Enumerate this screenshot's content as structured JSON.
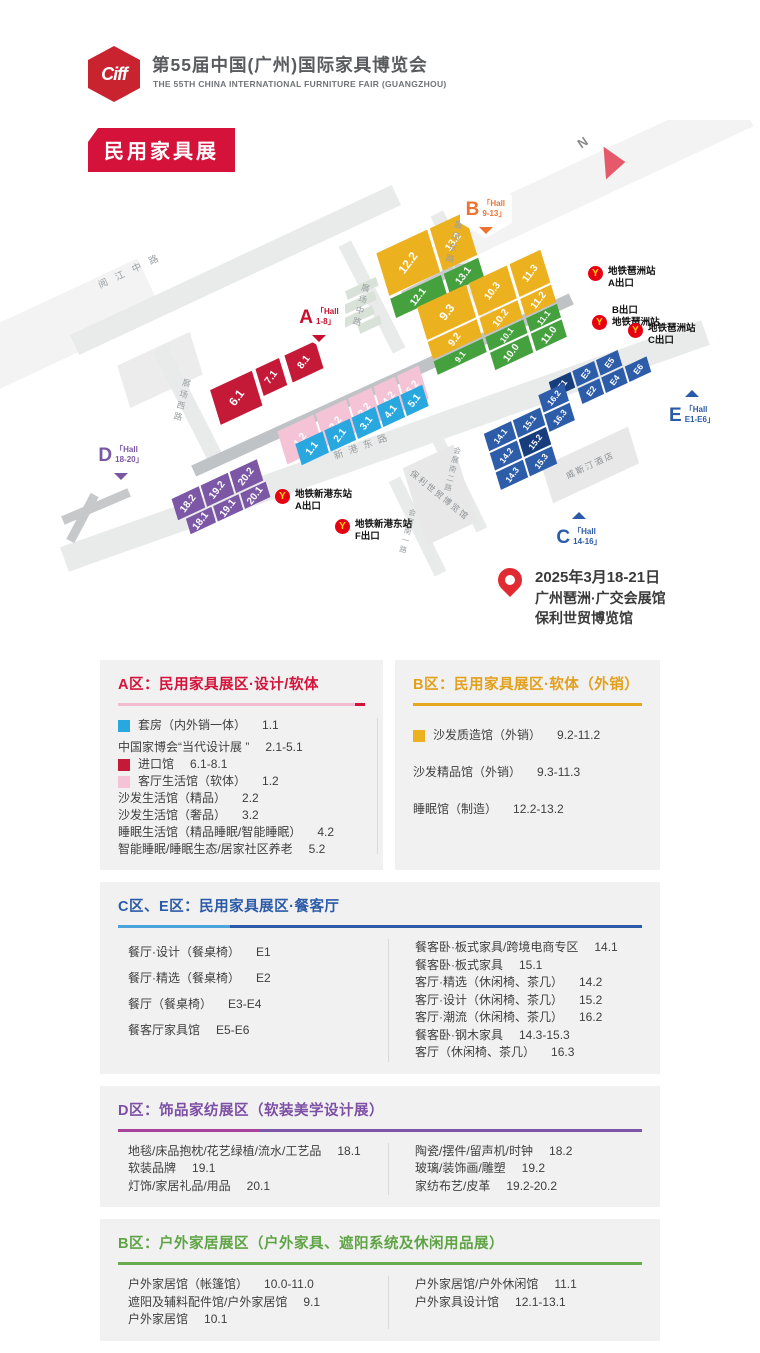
{
  "header": {
    "logo_text": "Ciff",
    "title": "第55届中国(广州)国际家具博览会",
    "subtitle": "THE 55TH CHINA INTERNATIONAL FURNITURE FAIR (GUANGZHOU)",
    "badge": "民用家具展"
  },
  "theme": {
    "zone_red": "#c41a38",
    "zone_pink": "#f4c3d6",
    "zone_cyan": "#29a8e0",
    "zone_yellow": "#ecb11f",
    "zone_green": "#44a13d",
    "zone_blue": "#2d5ca9",
    "zone_navy": "#173d7d",
    "zone_purple": "#7b57a5",
    "accent_a": "#d5133a",
    "accent_b": "#e5a71f",
    "accent_ce": "#2b5ba8",
    "accent_d": "#7d4fa5",
    "accent_b2": "#6aaa4e",
    "metro_red": "#e60012",
    "metro_yellow": "#ffd800"
  },
  "map": {
    "compass": "N",
    "hex": [
      {
        "letter": "A",
        "l1": "「Hall",
        "l2": "1-8」"
      },
      {
        "letter": "B",
        "l1": "「Hall",
        "l2": "9-13」"
      },
      {
        "letter": "C",
        "l1": "「Hall",
        "l2": "14-16」"
      },
      {
        "letter": "D",
        "l1": "「Hall",
        "l2": "18-20」"
      },
      {
        "letter": "E",
        "l1": "「Hall",
        "l2": "E1-E6」"
      }
    ],
    "blocks": {
      "red": [
        "6.1",
        "7.1",
        "8.1"
      ],
      "pink": [
        "1.2",
        "2.2",
        "3.2",
        "4.2",
        "5.2"
      ],
      "cyan": [
        "1.1",
        "2.1",
        "3.1",
        "4.1",
        "5.1"
      ],
      "y1213": [
        "12.2",
        "13.2"
      ],
      "g1213": [
        "12.1",
        "13.1"
      ],
      "y911": [
        "9.3",
        "10.3",
        "11.3",
        "9.2",
        "10.2",
        "11.2"
      ],
      "g911": [
        "9.1",
        "10.1",
        "11.1",
        "10.0",
        "11.0"
      ],
      "e": [
        "E1",
        "E3",
        "E5",
        "E2",
        "E4",
        "E6"
      ],
      "c": [
        "14.1",
        "15.1",
        "14.2",
        "15.2",
        "14.3",
        "15.3",
        "16.2",
        "16.3"
      ],
      "d": [
        "18.2",
        "19.2",
        "20.2",
        "18.1",
        "19.1",
        "20.1"
      ]
    },
    "streets": [
      "阅江中路",
      "展场西路",
      "展场中路",
      "展场东路",
      "新港东路",
      "会展南一路",
      "会展南二路"
    ],
    "buildings": [
      "威斯汀酒店",
      "保利世贸博览馆"
    ],
    "metro": [
      {
        "line1": "地铁琶洲站",
        "line2": "A出口"
      },
      {
        "line1": "B出口",
        "line2": "地铁琶洲站"
      },
      {
        "line1": "地铁琶洲站",
        "line2": "C出口"
      },
      {
        "line1": "地铁新港东站",
        "line2": "A出口"
      },
      {
        "line1": "地铁新港东站",
        "line2": "F出口"
      }
    ],
    "event": {
      "date": "2025年3月18-21日",
      "venue1": "广州琶洲·广交会展馆",
      "venue2": "保利世贸博览馆"
    }
  },
  "sections": {
    "a": {
      "title": "A区：民用家具展区·设计/软体",
      "items": [
        {
          "swatch": "#29a8e0",
          "label": "套房（内外销一体）",
          "code": "1.1"
        },
        {
          "swatch": "",
          "label": "中国家博会“当代设计展 ”",
          "code": "2.1-5.1"
        },
        {
          "swatch": "#c41a38",
          "label": "进口馆",
          "code": "6.1-8.1"
        },
        {
          "swatch": "#f4c3d6",
          "label": "客厅生活馆（软体）",
          "code": "1.2"
        },
        {
          "swatch": "",
          "label": "沙发生活馆（精品）",
          "code": "2.2"
        },
        {
          "swatch": "",
          "label": "沙发生活馆（奢品）",
          "code": "3.2"
        },
        {
          "swatch": "",
          "label": "睡眠生活馆（精品睡眠/智能睡眠）",
          "code": "4.2"
        },
        {
          "swatch": "",
          "label": "智能睡眠/睡眠生态/居家社区养老",
          "code": "5.2"
        }
      ]
    },
    "b": {
      "title": "B区：民用家具展区·软体（外销）",
      "items": [
        {
          "swatch": "#ecb11f",
          "label": "沙发质造馆（外销）",
          "code": "9.2-11.2"
        },
        {
          "swatch": "",
          "label": "沙发精品馆（外销）",
          "code": "9.3-11.3"
        },
        {
          "swatch": "",
          "label": "睡眠馆（制造）",
          "code": "12.2-13.2"
        }
      ]
    },
    "ce": {
      "title": "C区、E区：民用家具展区·餐客厅",
      "left": [
        {
          "label": "餐厅·设计（餐桌椅）",
          "code": "E1"
        },
        {
          "label": "餐厅·精选（餐桌椅）",
          "code": "E2"
        },
        {
          "label": "餐厅（餐桌椅）",
          "code": "E3-E4"
        },
        {
          "label": "餐客厅家具馆",
          "code": "E5-E6"
        }
      ],
      "right": [
        {
          "label": "餐客卧·板式家具/跨境电商专区",
          "code": "14.1"
        },
        {
          "label": "餐客卧·板式家具",
          "code": "15.1"
        },
        {
          "label": "客厅·精选（休闲椅、茶几）",
          "code": "14.2"
        },
        {
          "label": "客厅·设计（休闲椅、茶几）",
          "code": "15.2"
        },
        {
          "label": "客厅·潮流（休闲椅、茶几）",
          "code": "16.2"
        },
        {
          "label": "餐客卧·钢木家具",
          "code": "14.3-15.3"
        },
        {
          "label": "客厅（休闲椅、茶几）",
          "code": "16.3"
        }
      ]
    },
    "d": {
      "title": "D区：饰品家纺展区（软装美学设计展）",
      "left": [
        {
          "label": "地毯/床品抱枕/花艺绿植/流水/工艺品",
          "code": "18.1"
        },
        {
          "label": "软装品牌",
          "code": "19.1"
        },
        {
          "label": "灯饰/家居礼品/用品",
          "code": "20.1"
        }
      ],
      "right": [
        {
          "label": "陶瓷/摆件/留声机/时钟",
          "code": "18.2"
        },
        {
          "label": "玻璃/装饰画/雕塑",
          "code": "19.2"
        },
        {
          "label": "家纺布艺/皮革",
          "code": "19.2-20.2"
        }
      ]
    },
    "b2": {
      "title": "B区：户外家居展区（户外家具、遮阳系统及休闲用品展）",
      "left": [
        {
          "label": "户外家居馆（帐篷馆）",
          "code": "10.0-11.0"
        },
        {
          "label": "遮阳及辅料配件馆/户外家居馆",
          "code": "9.1"
        },
        {
          "label": "户外家居馆",
          "code": "10.1"
        }
      ],
      "right": [
        {
          "label": "户外家居馆/户外休闲馆",
          "code": "11.1"
        },
        {
          "label": "户外家具设计馆",
          "code": "12.1-13.1"
        }
      ]
    }
  }
}
